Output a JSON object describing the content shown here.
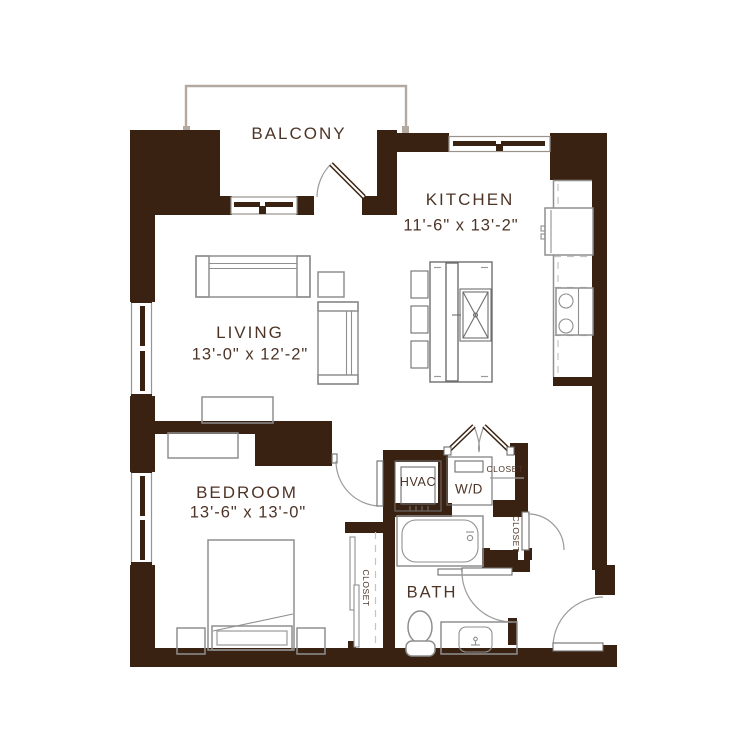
{
  "app": {
    "type": "apartment-floor-plan"
  },
  "colors": {
    "wall": "#3a2212",
    "label": "#4d3427",
    "furn": "#8f8f8f",
    "win": "#9a938c",
    "balc": "#b3a9a1"
  },
  "rooms": {
    "balcony": {
      "label": "BALCONY"
    },
    "kitchen": {
      "label": "KITCHEN",
      "dims": "11'-6\" x 13'-2\""
    },
    "living": {
      "label": "LIVING",
      "dims": "13'-0\" x 12'-2\""
    },
    "bedroom": {
      "label": "BEDROOM",
      "dims": "13'-6\" x 13'-0\""
    },
    "bath": {
      "label": "BATH"
    },
    "hvac": {
      "label": "HVAC"
    },
    "laundry": {
      "label": "W/D"
    },
    "closet_hall": {
      "label": "CLOSET"
    },
    "closet_entry": {
      "label": "CLOSET"
    },
    "closet_bedroom": {
      "label": "CLOSET"
    }
  }
}
